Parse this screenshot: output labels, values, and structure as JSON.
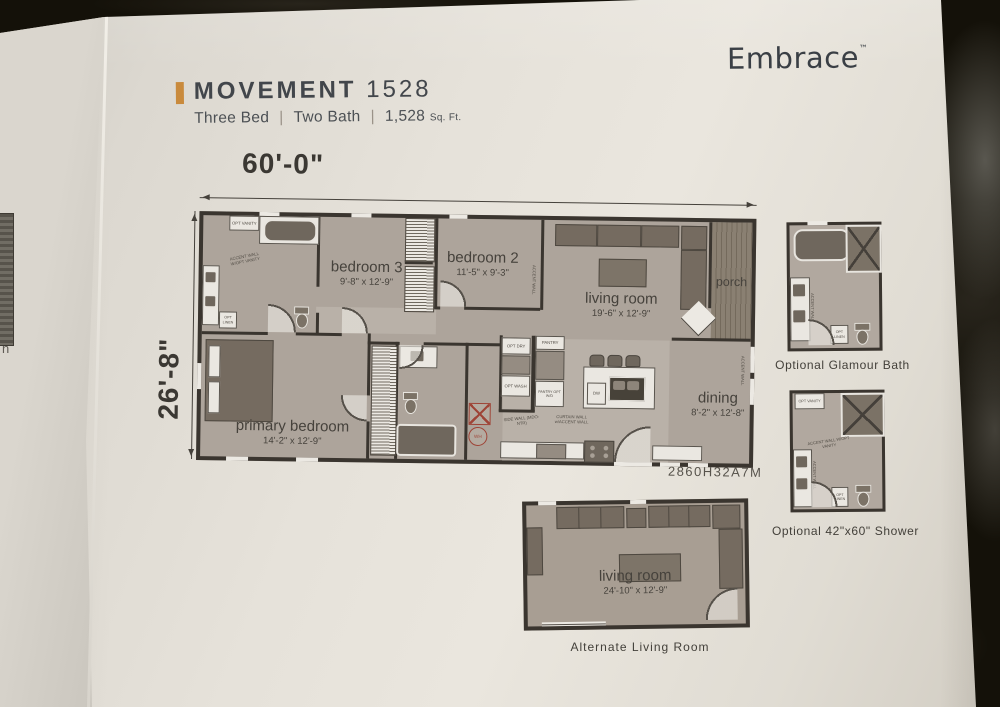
{
  "brand": {
    "name": "Embrace",
    "tm": "™"
  },
  "header": {
    "title_main": "MOVEMENT",
    "title_number": "1528",
    "spec_bed": "Three Bed",
    "spec_bath": "Two Bath",
    "sqft": "1,528",
    "sqft_unit": "Sq. Ft.",
    "sep": "|"
  },
  "dims": {
    "width": "60'-0\"",
    "depth": "26'-8\""
  },
  "plan": {
    "model_number": "2860H32A7M",
    "rooms": [
      {
        "name": "bedroom 3",
        "dims": "9'-8\" x 12'-9\""
      },
      {
        "name": "bedroom 2",
        "dims": "11'-5\" x 9'-3\""
      },
      {
        "name": "living room",
        "dims": "19'-6\" x 12'-9\""
      },
      {
        "name": "porch",
        "dims": ""
      },
      {
        "name": "dining",
        "dims": "8'-2\" x 12'-8\""
      },
      {
        "name": "primary bedroom",
        "dims": "14'-2\" x 12'-9\""
      }
    ],
    "micro": {
      "opt_vanity": "OPT VANITY",
      "accent_wall_opt_vanity": "ACCENT WALL W/OPT VANITY",
      "opt_linen": "OPT LINEN",
      "accent_wall": "ACCENT WALL",
      "pantry": "PANTRY",
      "opt_dry": "OPT DRY",
      "opt_wash": "OPT WASH",
      "pantry_opt_wd": "PANTRY OPT W/D",
      "side_wall": "SIDE WALL (MDO-NTR)",
      "curtain_wall": "CURTAIN WALL w/ACCENT WALL",
      "dw": "DW",
      "wh": "WH"
    }
  },
  "insets": {
    "glamour": {
      "caption": "Optional Glamour Bath"
    },
    "shower": {
      "caption": "Optional 42\"x60\" Shower"
    },
    "alt": {
      "caption": "Alternate Living Room",
      "room": "living room",
      "dims": "24'-10\" x 12'-9\""
    }
  },
  "page_edge": {
    "letter": "n"
  },
  "colors": {
    "accent": "#c98a3c",
    "paper": "#e7e3db",
    "granite": "#141109",
    "wall": "#3a352f",
    "floor": "#ada49b",
    "utility_red": "#9e4437"
  }
}
